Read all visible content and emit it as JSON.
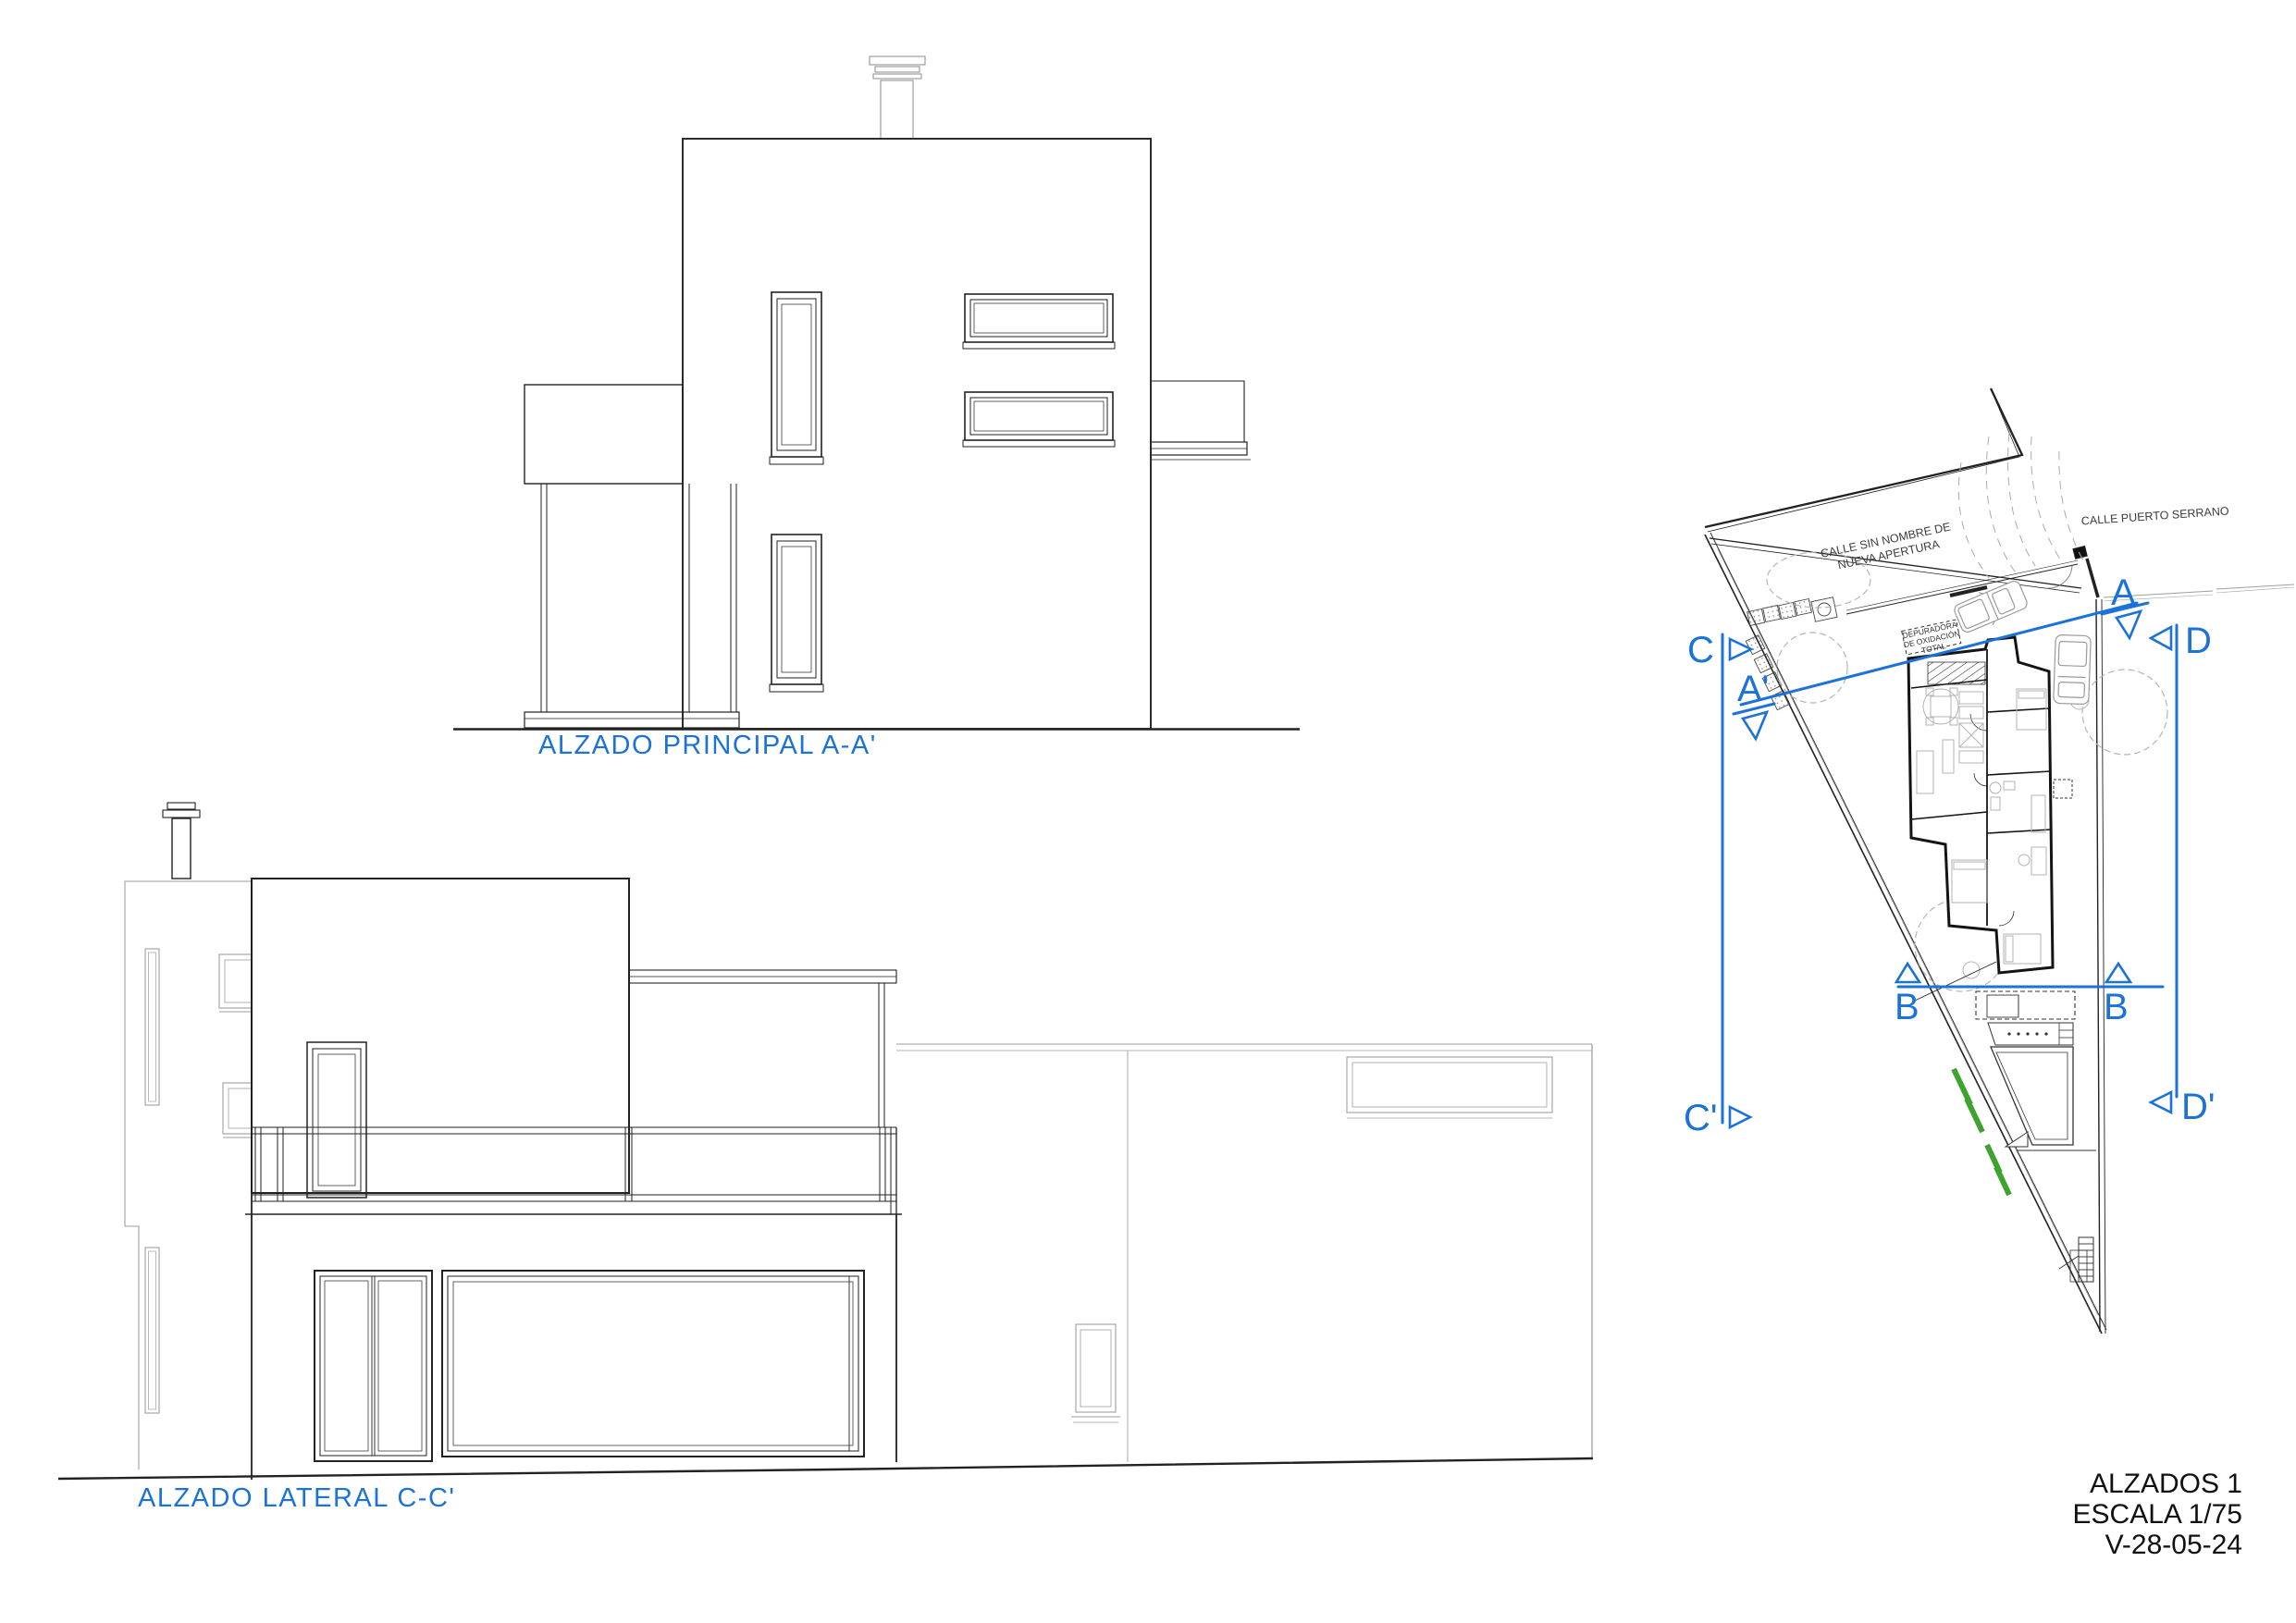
{
  "sheet": {
    "type_note": "architectural elevations and site plan sheet"
  },
  "elevations": {
    "principal": {
      "label": "ALZADO PRINCIPAL A-A'"
    },
    "lateral": {
      "label": "ALZADO LATERAL C-C'"
    }
  },
  "site_plan": {
    "streets": {
      "new_street_line1": "CALLE SIN NOMBRE DE",
      "new_street_line2": "NUEVA APERTURA",
      "puerto_serrano": "CALLE PUERTO SERRANO"
    },
    "equipment": {
      "depuradora_line1": "DEPURADORA",
      "depuradora_line2": "DE OXIDACIÓN",
      "depuradora_line3": "TOTAL"
    },
    "section_markers": {
      "a": "A",
      "a_prime": "A'",
      "b_left": "B",
      "b_right": "B",
      "c": "C",
      "c_prime": "C'",
      "d": "D",
      "d_prime": "D'"
    },
    "colors": {
      "section_blue": "#1b72d8",
      "hedge_green": "#3fa32f"
    }
  },
  "title_block": {
    "line1": "ALZADOS 1",
    "line2": "ESCALA 1/75",
    "line3": "V-28-05-24"
  }
}
